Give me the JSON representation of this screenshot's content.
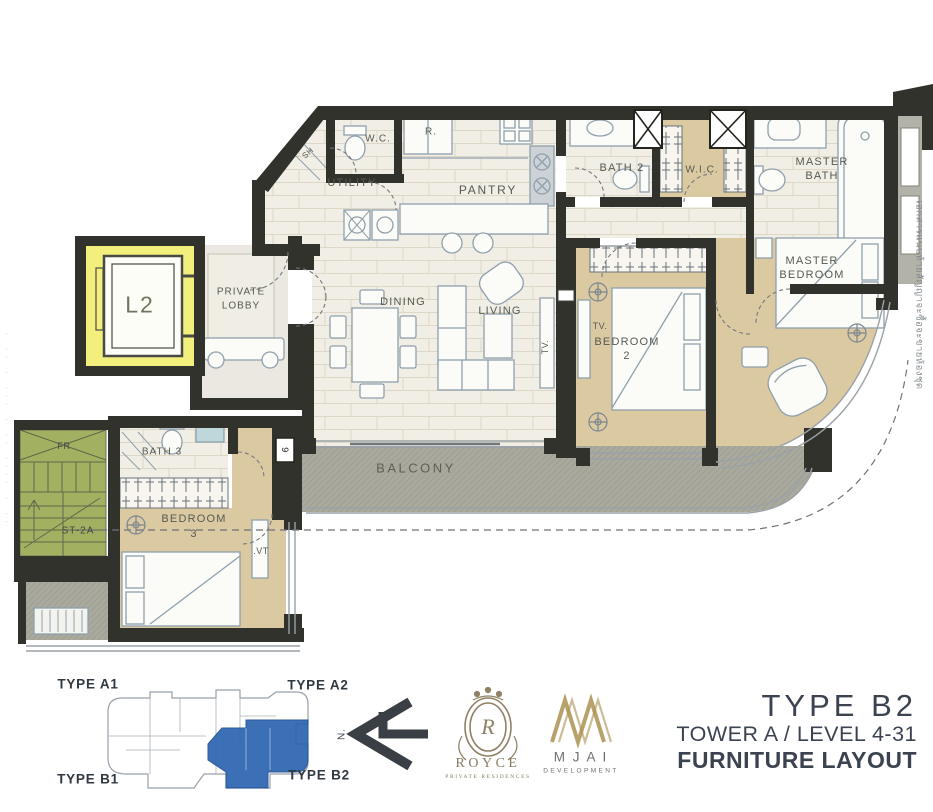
{
  "plan_labels": {
    "wc": "W.C.",
    "refrigerator": "R.",
    "utility": "UTILITY",
    "pantry": "PANTRY",
    "bath2": "BATH 2",
    "wic": "W.I.C.",
    "master_bath_line1": "MASTER",
    "master_bath_line2": "BATH",
    "master_bedroom_line1": "MASTER",
    "master_bedroom_line2": "BEDROOM",
    "bedroom2_line1": "BEDROOM",
    "bedroom2_line2": "2",
    "dining": "DINING",
    "living": "LIVING",
    "tv_living": "TV.",
    "tv_bedroom2": "TV.",
    "tv_bedroom3": ".VT",
    "private_lobby_line1": "PRIVATE",
    "private_lobby_line2": "LOBBY",
    "elevator": "L2",
    "bath3": "BATH 3",
    "bedroom3_line1": "BEDROOM",
    "bedroom3_line2": "3",
    "balcony": "BALCONY",
    "stairs": "ST-2A",
    "fire_riser": "FR",
    "shower": "SH",
    "door_tag": "9",
    "north": "N."
  },
  "key_plan": {
    "type_a1": "TYPE A1",
    "type_a2": "TYPE A2",
    "type_b1": "TYPE B1",
    "type_b2": "TYPE B2",
    "highlight_color": "#2b64b0"
  },
  "branding": {
    "royce_monogram": "R",
    "royce_name": "ROYCE",
    "royce_subtitle": "PRIVATE RESIDENCES",
    "mjai_name": "M J A I",
    "mjai_subtitle": "DEVELOPMENT",
    "gold": "#ab9150",
    "royce_tone": "#877c60"
  },
  "title_block": {
    "unit_type": "TYPE  B2",
    "tower_level": "TOWER A / LEVEL 4-31",
    "drawing_name": "FURNITURE LAYOUT",
    "ink": "#3b4250"
  },
  "margin_notes": {
    "right_vertical_text": "เอกสารแนบท้ายสัญญาจะซื้อจะขายห้องชุด",
    "left_vertical_text": "· ·· · ··· · ·· ···· · ··"
  },
  "palette": {
    "wall": "#32322c",
    "tile_floor": "#f1eee5",
    "tile_joint": "#ddd7c8",
    "carpet": "#dbc9a2",
    "balcony_gray": "#a9a99e",
    "stair_green": "#a2b161",
    "elevator_yellow": "#f2ef7c",
    "furniture_line": "#8fa0ac",
    "label_ink": "#565a51"
  }
}
